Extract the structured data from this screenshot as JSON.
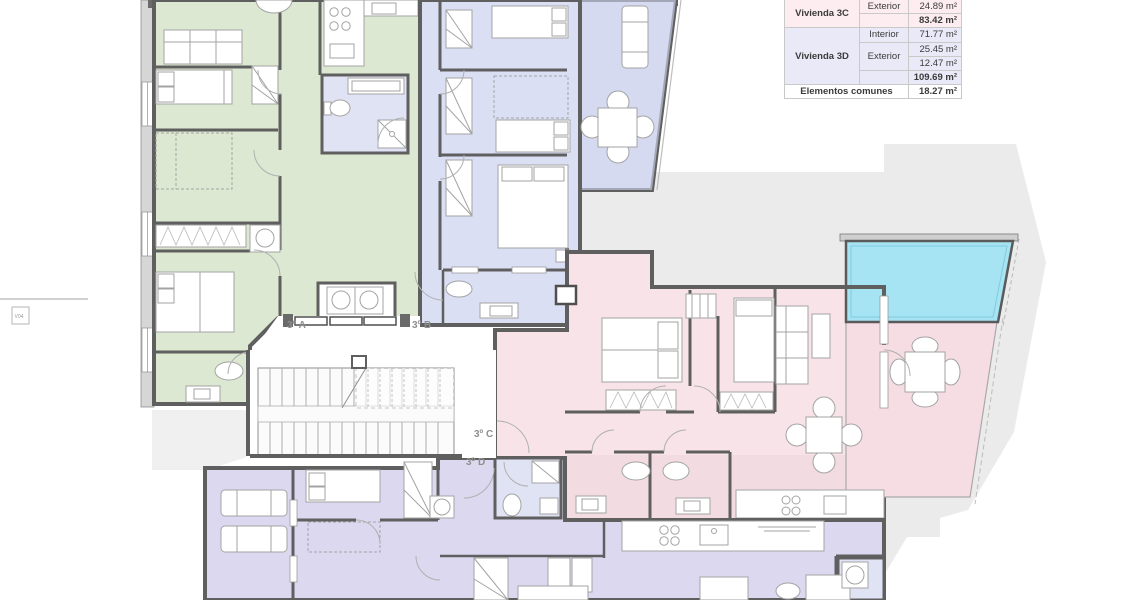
{
  "plan": {
    "title": "floor-plan-third-floor",
    "unit_labels": {
      "a": "3º A",
      "b": "3º B",
      "c": "3º C",
      "d": "3º D"
    },
    "window_label": "V04",
    "colors": {
      "apartment_3a": "#dce8d2",
      "apartment_3b": "#dbdff4",
      "apartment_3c": "#f8e4e8",
      "apartment_3d": "#dcd8f0",
      "bathroom": "#e0e3f4",
      "pool": "#a6e3f3",
      "terrace_pink": "#f6dde3",
      "surround_gray": "#ebebeb",
      "wall": "#5f5f5f"
    }
  },
  "area_table": {
    "units": [
      {
        "name": "Vivienda 3C",
        "rows": [
          {
            "zone": "Exterior",
            "value": "24.89 m²"
          }
        ],
        "total": "83.42 m²"
      },
      {
        "name": "Vivienda 3D",
        "rows": [
          {
            "zone": "Interior",
            "value": "71.77 m²"
          },
          {
            "zone": "Exterior",
            "value": "25.45 m²"
          },
          {
            "zone": "Exterior",
            "value": "12.47 m²"
          }
        ],
        "total": "109.69 m²"
      }
    ],
    "common": {
      "name": "Elementos comunes",
      "value": "18.27 m²"
    }
  }
}
